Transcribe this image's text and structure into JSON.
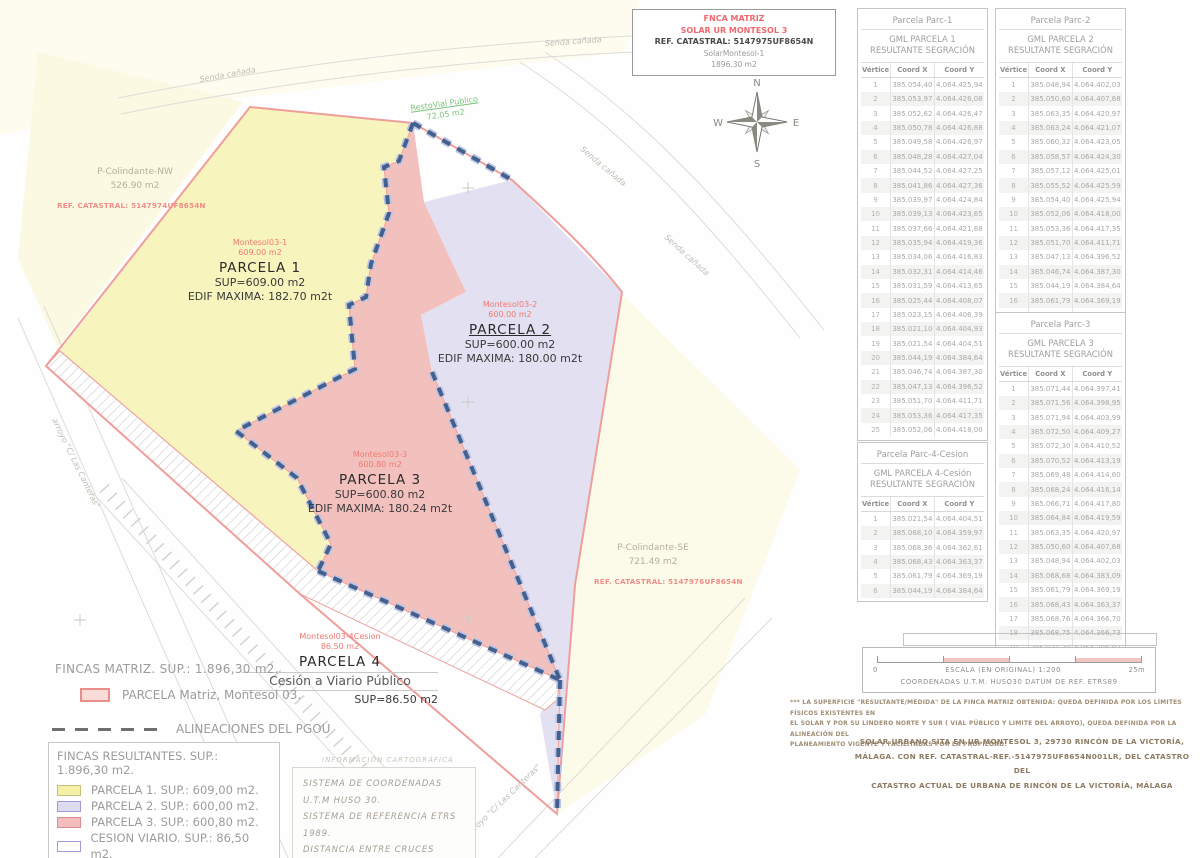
{
  "title_block": {
    "line1": "FNCA MATRIZ",
    "line2": "SOLAR UR MONTESOL 3",
    "line3": "REF. CATASTRAL: 5147975UF8654N",
    "line4": "SolarMontesol-1",
    "line5": "1896.30 m2"
  },
  "compass": {
    "n": "N",
    "e": "E",
    "s": "S",
    "w": "W"
  },
  "plan": {
    "road_label": "Senda cañada",
    "stream_label": "arroyo  \"C/ Las Canteras\"",
    "resto_vial": {
      "name": "RestoVial Publico",
      "area": "72.05 m2"
    },
    "colindante_nw": {
      "name": "P-Colindante-NW",
      "area": "526.90 m2",
      "ref": "REF. CATASTRAL: 5147974UF8654N"
    },
    "colindante_se": {
      "name": "P-Colindante-SE",
      "area": "721.49 m2",
      "ref": "REF. CATASTRAL: 5147976UF8654N"
    },
    "parcels": {
      "p1": {
        "tag": "Montesol03-1",
        "tag_area": "609.00 m2",
        "name": "PARCELA 1",
        "sup": "SUP=609.00 m2",
        "edif": "EDIF MAXIMA: 182.70 m2t"
      },
      "p2": {
        "tag": "Montesol03-2",
        "tag_area": "600.00 m2",
        "name": "PARCELA 2",
        "sup": "SUP=600.00 m2",
        "edif": "EDIF MAXIMA: 180.00 m2t"
      },
      "p3": {
        "tag": "Montesol03-3",
        "tag_area": "600.80 m2",
        "name": "PARCELA 3",
        "sup": "SUP=600.80 m2",
        "edif": "EDIF MAXIMA: 180.24 m2t"
      },
      "p4": {
        "tag": "Montesol03-4Cesion",
        "tag_area": "86.50 m2",
        "name": "PARCELA 4",
        "subtitle": "Cesión a Viario Público",
        "sup": "SUP=86.50 m2"
      }
    }
  },
  "legend": {
    "matriz_heading": "FINCAS MATRIZ.  SUP.: 1.896,30 m2.",
    "matriz_item": {
      "label": "PARCELA Matriz, Montesol 03.",
      "fill": "#f9dbd8",
      "border": "#e98f8b"
    },
    "alineaciones_label": "ALINEACIONES DEL PGOU",
    "resultantes": {
      "heading": "FINCAS RESULTANTES. SUP.: 1.896,30 m2.",
      "items": [
        {
          "label": "PARCELA 1. SUP.: 609,00 m2.",
          "fill": "#f4f0a6",
          "border": "#c9bf7a"
        },
        {
          "label": "PARCELA 2. SUP.: 600,00 m2.",
          "fill": "#dddbf0",
          "border": "#9f9dd8"
        },
        {
          "label": "PARCELA 3. SUP.: 600,80 m2.",
          "fill": "#f3bdbd",
          "border": "#d98f8f"
        },
        {
          "label": "CESION VIARIO. SUP.: 86,50 m2.",
          "fill": "#ffffff",
          "border": "#9f9dd8"
        }
      ]
    }
  },
  "cartography": {
    "heading": "INFORMACIÓN CARTOGRÁFICA",
    "line1": "SISTEMA DE COORDENADAS U.T.M HUSO 30.",
    "line2": "SISTEMA DE REFERENCIA ETRS 1989.",
    "line3": "DISTANCIA ENTRE CRUCES 25,00 m."
  },
  "table_headers": [
    "Vértice",
    "Coord X",
    "Coord Y"
  ],
  "tables": [
    {
      "id": "parc-1",
      "title": "Parcela Parc-1",
      "subtitle": [
        "GML PARCELA 1",
        "RESULTANTE SEGRACIÓN"
      ],
      "rows": [
        [
          "1",
          "385.054,40",
          "4.064.425,94"
        ],
        [
          "2",
          "385.053,97",
          "4.064.426,08"
        ],
        [
          "3",
          "385.052,62",
          "4.064.426,47"
        ],
        [
          "4",
          "385.050,78",
          "4.064.426,88"
        ],
        [
          "5",
          "385.049,58",
          "4.064.426,97"
        ],
        [
          "6",
          "385.048,28",
          "4.064.427,04"
        ],
        [
          "7",
          "385.044,52",
          "4.064.427,25"
        ],
        [
          "8",
          "385.041,86",
          "4.064.427,36"
        ],
        [
          "9",
          "385.039,97",
          "4.064.424,84"
        ],
        [
          "10",
          "385.039,13",
          "4.064.423,65"
        ],
        [
          "11",
          "385.037,66",
          "4.064.421,68"
        ],
        [
          "12",
          "385.035,94",
          "4.064.419,36"
        ],
        [
          "13",
          "385.034,06",
          "4.064.416,83"
        ],
        [
          "14",
          "385.032,31",
          "4.064.414,46"
        ],
        [
          "15",
          "385.031,59",
          "4.064.413,65"
        ],
        [
          "16",
          "385.025,44",
          "4.064.408,07"
        ],
        [
          "17",
          "385.023,15",
          "4.064.406,39"
        ],
        [
          "18",
          "385.021,10",
          "4.064.404,93"
        ],
        [
          "19",
          "385.021,54",
          "4.064.404,51"
        ],
        [
          "20",
          "385.044,19",
          "4.064.384,64"
        ],
        [
          "21",
          "385.046,74",
          "4.064.387,30"
        ],
        [
          "22",
          "385.047,13",
          "4.064.396,52"
        ],
        [
          "23",
          "385.051,70",
          "4.064.411,71"
        ],
        [
          "24",
          "385.053,36",
          "4.064.417,35"
        ],
        [
          "25",
          "385.052,06",
          "4.064.418,00"
        ]
      ]
    },
    {
      "id": "parc-2",
      "title": "Parcela Parc-2",
      "subtitle": [
        "GML PARCELA 2",
        "RESULTANTE SEGRACIÓN"
      ],
      "rows": [
        [
          "1",
          "385.048,94",
          "4.064.402,03"
        ],
        [
          "2",
          "385.050,60",
          "4.064.407,68"
        ],
        [
          "3",
          "385.063,35",
          "4.064.420,97"
        ],
        [
          "4",
          "385.063,24",
          "4.064.421,07"
        ],
        [
          "5",
          "385.060,32",
          "4.064.423,05"
        ],
        [
          "6",
          "385.058,57",
          "4.064.424,30"
        ],
        [
          "7",
          "385.057,12",
          "4.064.425,01"
        ],
        [
          "8",
          "385.055,52",
          "4.064.425,59"
        ],
        [
          "9",
          "385.054,40",
          "4.064.425,94"
        ],
        [
          "10",
          "385.052,06",
          "4.064.418,00"
        ],
        [
          "11",
          "385.053,36",
          "4.064.417,35"
        ],
        [
          "12",
          "385.051,70",
          "4.064.411,71"
        ],
        [
          "13",
          "385.047,13",
          "4.064.396,52"
        ],
        [
          "14",
          "385.046,74",
          "4.064.387,30"
        ],
        [
          "15",
          "385.044,19",
          "4.064.384,64"
        ],
        [
          "16",
          "385.061,79",
          "4.064.369,19"
        ],
        [
          "17",
          "385.068,68",
          "4.064.383,09"
        ]
      ]
    },
    {
      "id": "parc-3",
      "title": "Parcela Parc-3",
      "subtitle": [
        "GML PARCELA 3",
        "RESULTANTE SEGRACIÓN"
      ],
      "rows": [
        [
          "1",
          "385.071,44",
          "4.064.397,41"
        ],
        [
          "2",
          "385.071,56",
          "4.064.398,95"
        ],
        [
          "3",
          "385.071,94",
          "4.064.403,99"
        ],
        [
          "4",
          "385.072,50",
          "4.064.409,27"
        ],
        [
          "5",
          "385.072,30",
          "4.064.410,52"
        ],
        [
          "6",
          "385.070,52",
          "4.064.413,19"
        ],
        [
          "7",
          "385.069,48",
          "4.064.414,60"
        ],
        [
          "8",
          "385.068,24",
          "4.064.416,14"
        ],
        [
          "9",
          "385.066,71",
          "4.064.417,80"
        ],
        [
          "10",
          "385.064,84",
          "4.064.419,59"
        ],
        [
          "11",
          "385.063,35",
          "4.064.420,97"
        ],
        [
          "12",
          "385.050,60",
          "4.064.407,68"
        ],
        [
          "13",
          "385.048,94",
          "4.064.402,03"
        ],
        [
          "14",
          "385.068,68",
          "4.064.383,09"
        ],
        [
          "15",
          "385.061,79",
          "4.064.369,19"
        ],
        [
          "16",
          "385.068,43",
          "4.064.363,37"
        ],
        [
          "17",
          "385.068,76",
          "4.064.366,70"
        ],
        [
          "18",
          "385.068,75",
          "4.064.366,73"
        ],
        [
          "19",
          "385.071,30",
          "4.064.395,93"
        ]
      ]
    },
    {
      "id": "parc-4-cesion",
      "title": "Parcela Parc-4-Cesion",
      "subtitle": [
        "GML PARCELA  4-Cesión",
        "RESULTANTE SEGRACIÓN"
      ],
      "rows": [
        [
          "1",
          "385.021,54",
          "4.064.404,51"
        ],
        [
          "2",
          "385.068,10",
          "4.064.359,97"
        ],
        [
          "3",
          "385.068,36",
          "4.064.362,61"
        ],
        [
          "4",
          "385.068,43",
          "4.064.363,37"
        ],
        [
          "5",
          "385.061,79",
          "4.064.369,19"
        ],
        [
          "6",
          "385.044,19",
          "4.064.384,64"
        ]
      ]
    }
  ],
  "scale_bar": {
    "zero": "0",
    "max": "25m",
    "label": "ESCALA (EN ORIGINAL) 1:200",
    "coords": "COORDENADAS U.T.M. HUSO30 DATUM DE REF. ETRS89"
  },
  "footnote": "*** LA SUPERFICIE \"RESULTANTE/MEDIDA\" DE LA FINCA MATRIZ OBTENIDA: QUEDA DEFINIDA POR LOS LÍMITES FÍSICOS  EXISTENTES EN\nEL SOLAR Y POR SU LINDERO NORTE Y SUR ( VIAL PÚBLICO Y LIMITE DEL ARROYO), QUEDA DEFINIDA POR  LA ALINEACIÓN DEL\nPLANEAMIENTO VIGENTE Y FACILITADAS POR LA PROPIEDAD.",
  "address": "SOLAR URBANO SITA EN UR MONTESOL 3, 29730 RINCÓN DE LA VICTORÍA,\nMÁLAGA. CON REF. CATASTRAL-REF.-5147975UF8654N001LR, DEL CATASTRO DEL\nCATASTRO ACTUAL DE URBANA DE RINCÓN DE LA VICTORÍA, MÁLAGA",
  "colors": {
    "parcel1_fill": "#f8f4bd",
    "parcel2_fill": "#e3e0f1",
    "parcel3_fill": "#f2c0bd",
    "matriz_boundary": "#ef9e9a",
    "alineaciones_dash": "#44608f",
    "green_label": "#7cc47c"
  }
}
